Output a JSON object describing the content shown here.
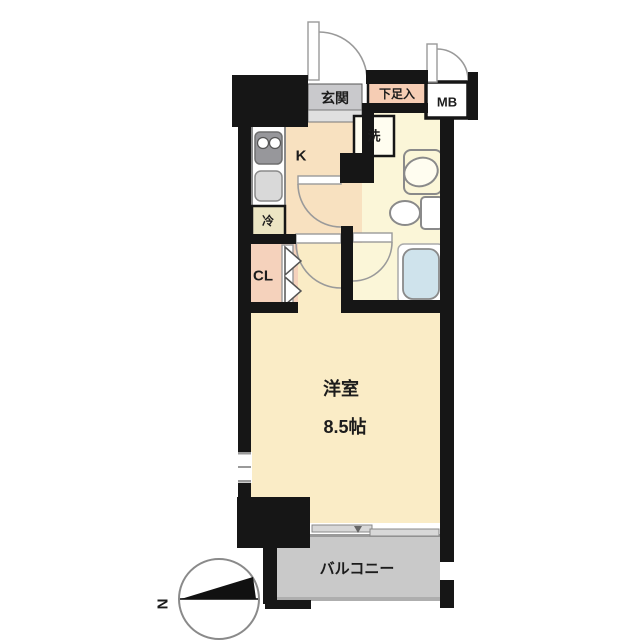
{
  "floorplan": {
    "rooms": {
      "entrance_label": "玄関",
      "shoe_cabinet_label": "下足入",
      "meter_box_label": "MB",
      "kitchen_label": "K",
      "washer_label": "洗",
      "refrigerator_label": "冷",
      "closet_label": "CL",
      "main_room_label": "洋室",
      "main_room_size": "8.5帖",
      "balcony_label": "バルコニー"
    },
    "compass": {
      "north_label": "N"
    },
    "colors": {
      "wall": "#161616",
      "kitchen_floor": "#f8e1c0",
      "main_room_floor": "#faecc6",
      "washroom_floor": "#fbf6d8",
      "closet_floor": "#f5d2bc",
      "shoe_cabinet_fill": "#f6cdb4",
      "entrance_fill": "#c9c9cc",
      "entrance_step_fill": "#e0e0e0",
      "balcony_fill": "#c9c9c9",
      "bathtub_fill": "#cfe3ec"
    }
  }
}
